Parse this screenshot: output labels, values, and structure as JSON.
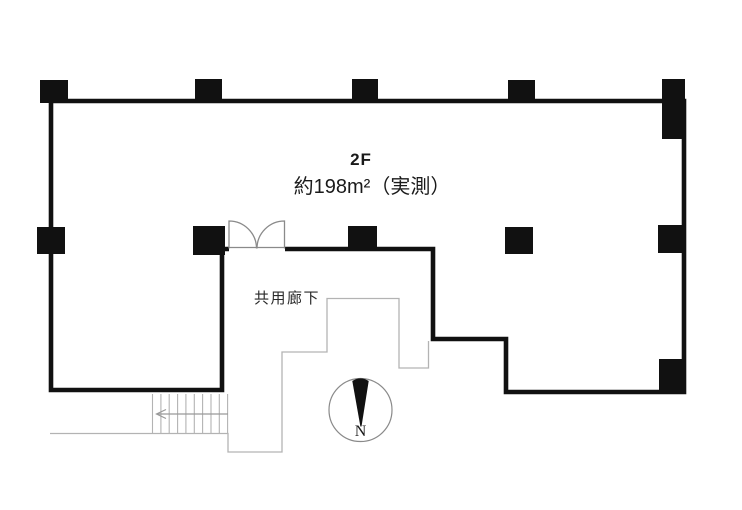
{
  "floor_plan": {
    "labels": {
      "floor": "2F",
      "area": "約198m²（実測）",
      "corridor": "共用廊下",
      "compass_north": "N"
    },
    "colors": {
      "wall": "#111111",
      "pillar": "#111111",
      "thin_line": "#b3b3b3",
      "door_line": "#8a8a8a",
      "arrow_line": "#999999",
      "compass_ring": "#8a8a8a",
      "needle": "#111111",
      "background": "#ffffff",
      "text": "#1a1a1a"
    }
  }
}
